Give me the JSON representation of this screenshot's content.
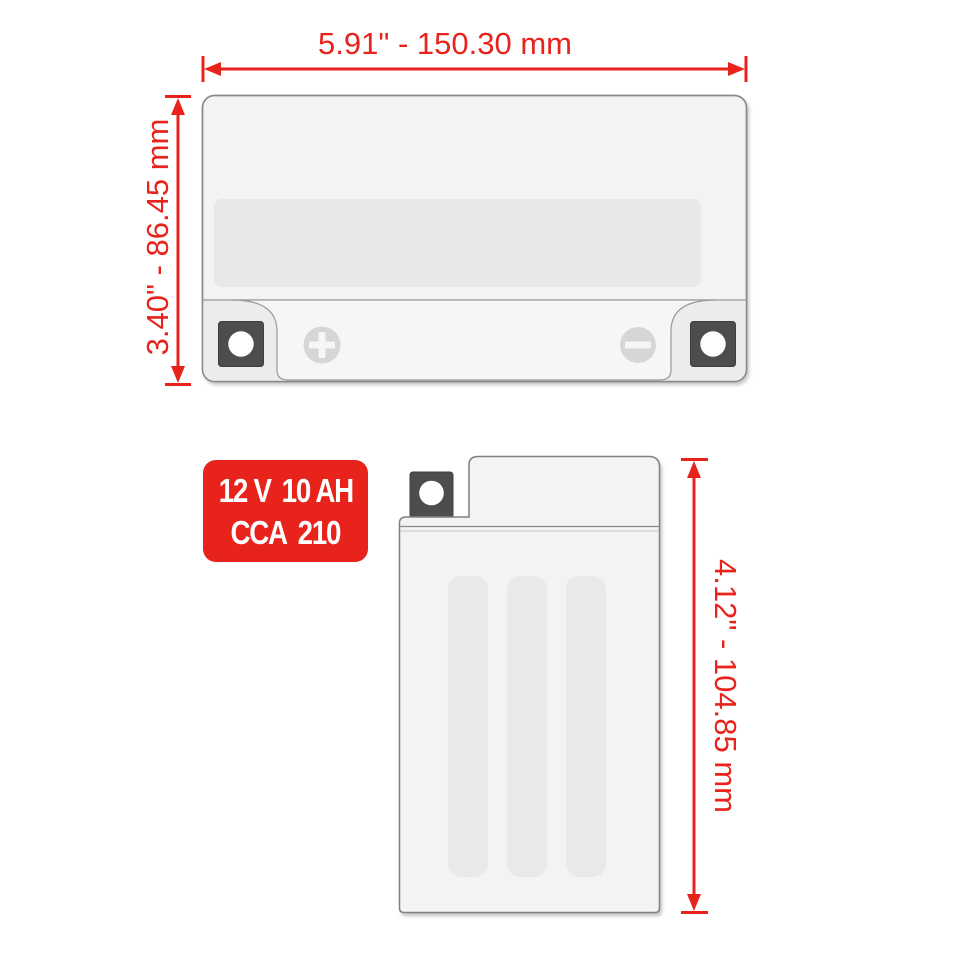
{
  "page": {
    "background_color": "#ffffff",
    "accent_color": "#e8231c",
    "battery_body_color": "#f3f3f3",
    "battery_panel_color": "#e8e8e8",
    "terminal_block_color": "#4d4d4d"
  },
  "badge": {
    "voltage": "12 V",
    "capacity": "10 AH",
    "cca_label": "CCA",
    "cca_value": "210",
    "background_color": "#e8231c",
    "text_color": "#ffffff"
  },
  "dimensions": {
    "width_label": "5.91\" - 150.30 mm",
    "height_label": "3.40\" - 86.45 mm",
    "depth_label": "4.12\" - 104.85 mm"
  }
}
